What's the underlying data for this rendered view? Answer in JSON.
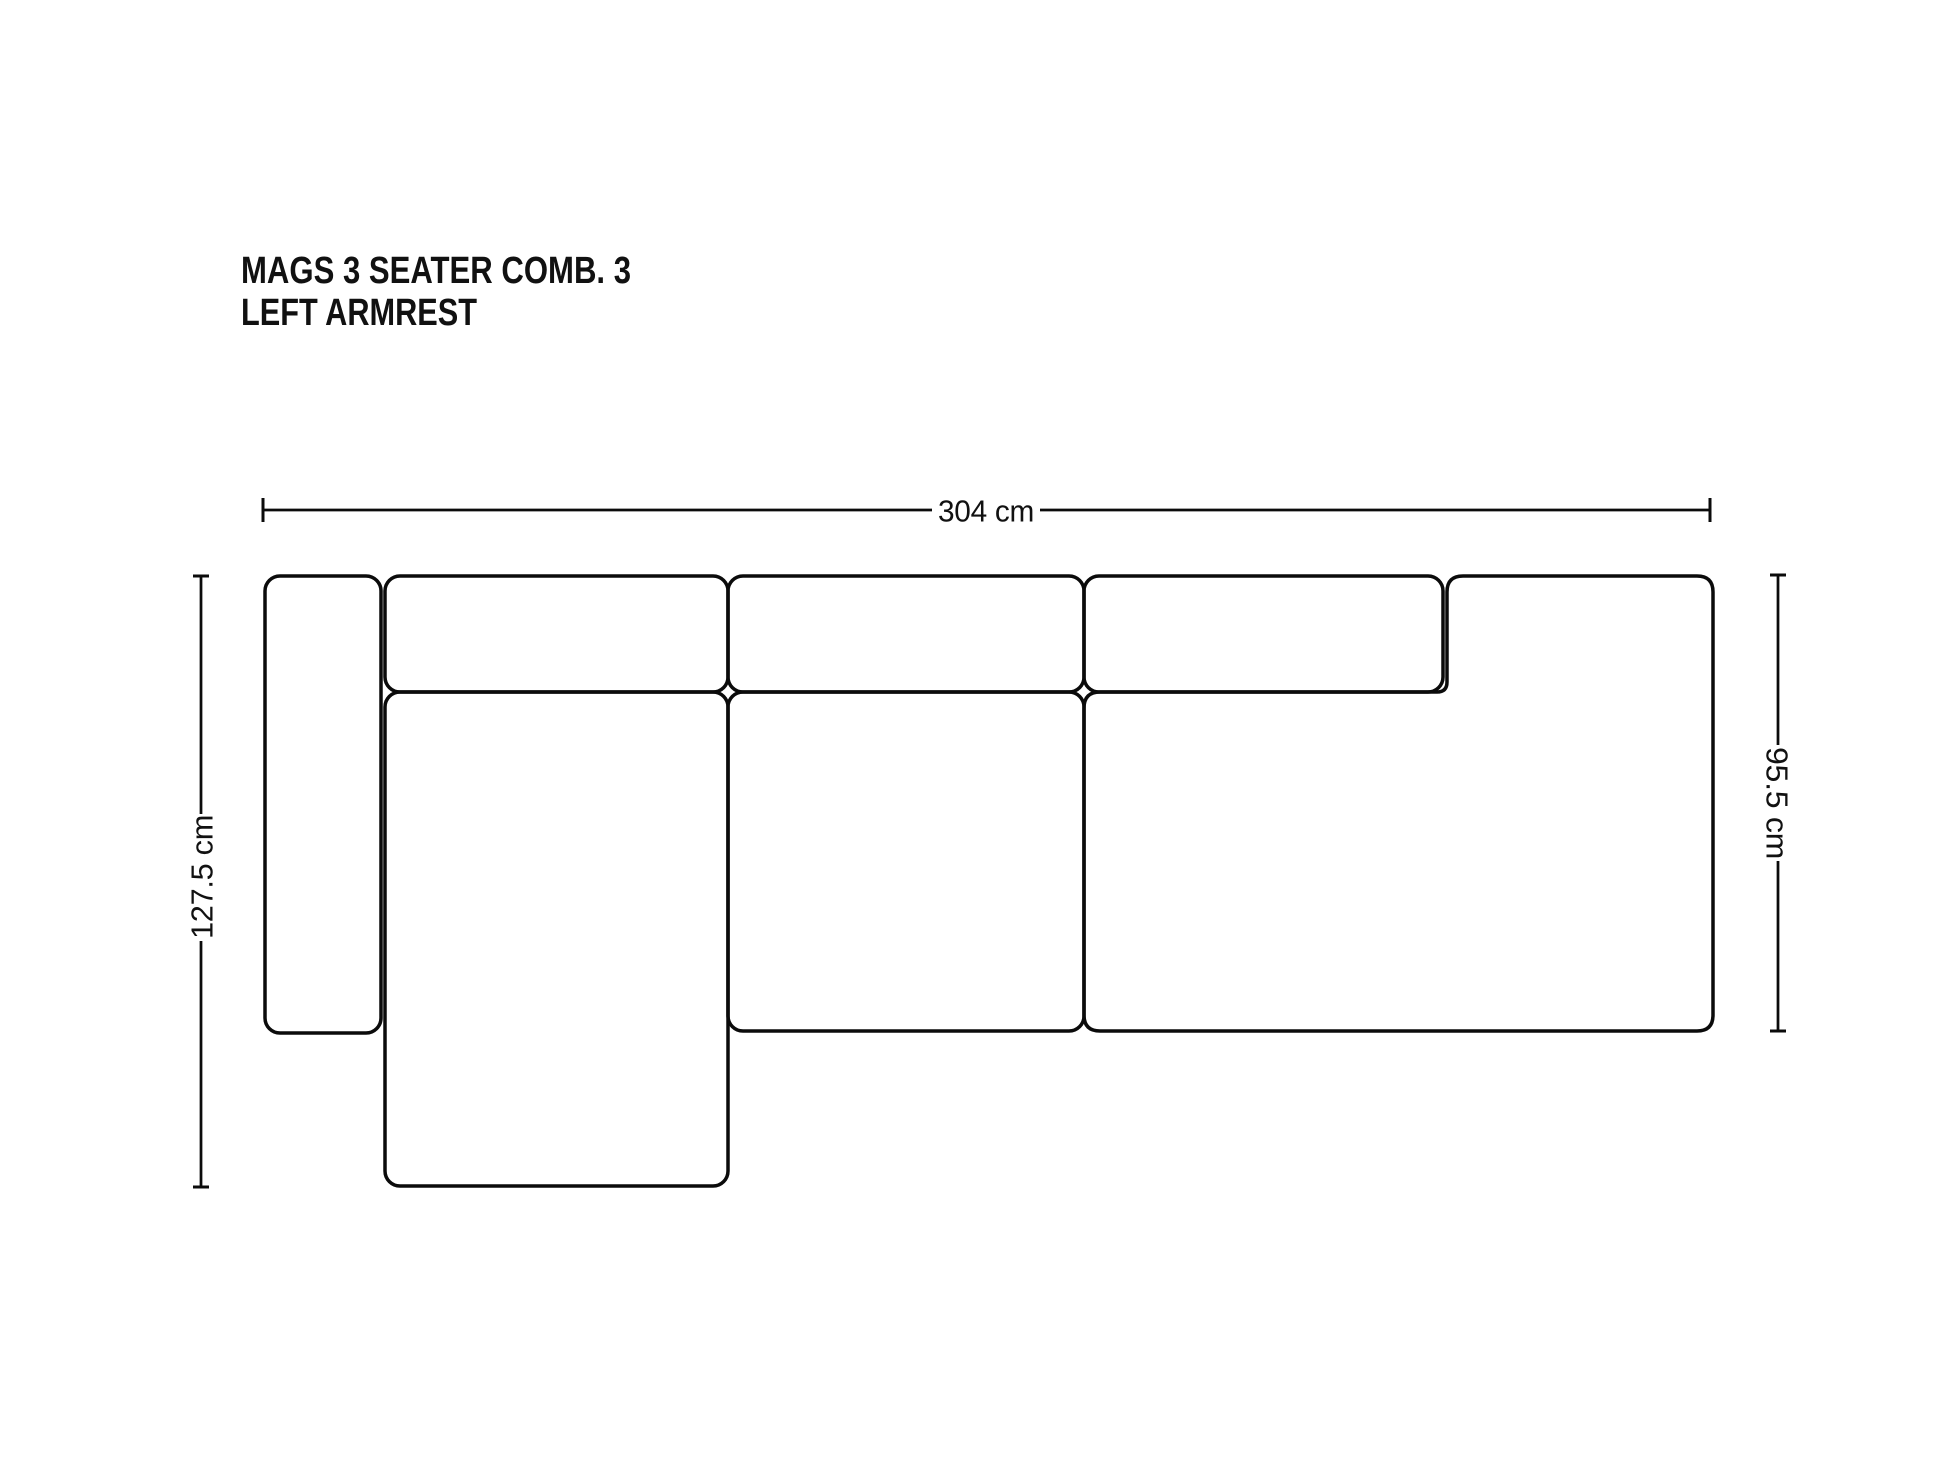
{
  "title": {
    "line1": "MAGS 3 SEATER COMB. 3",
    "line2": "LEFT ARMREST"
  },
  "dimensions": {
    "width": "304 cm",
    "total_depth": "127.5 cm",
    "seat_depth": "95.5 cm"
  },
  "colors": {
    "outline": "#0b0b0b",
    "text": "#111111",
    "background": "#ffffff"
  }
}
